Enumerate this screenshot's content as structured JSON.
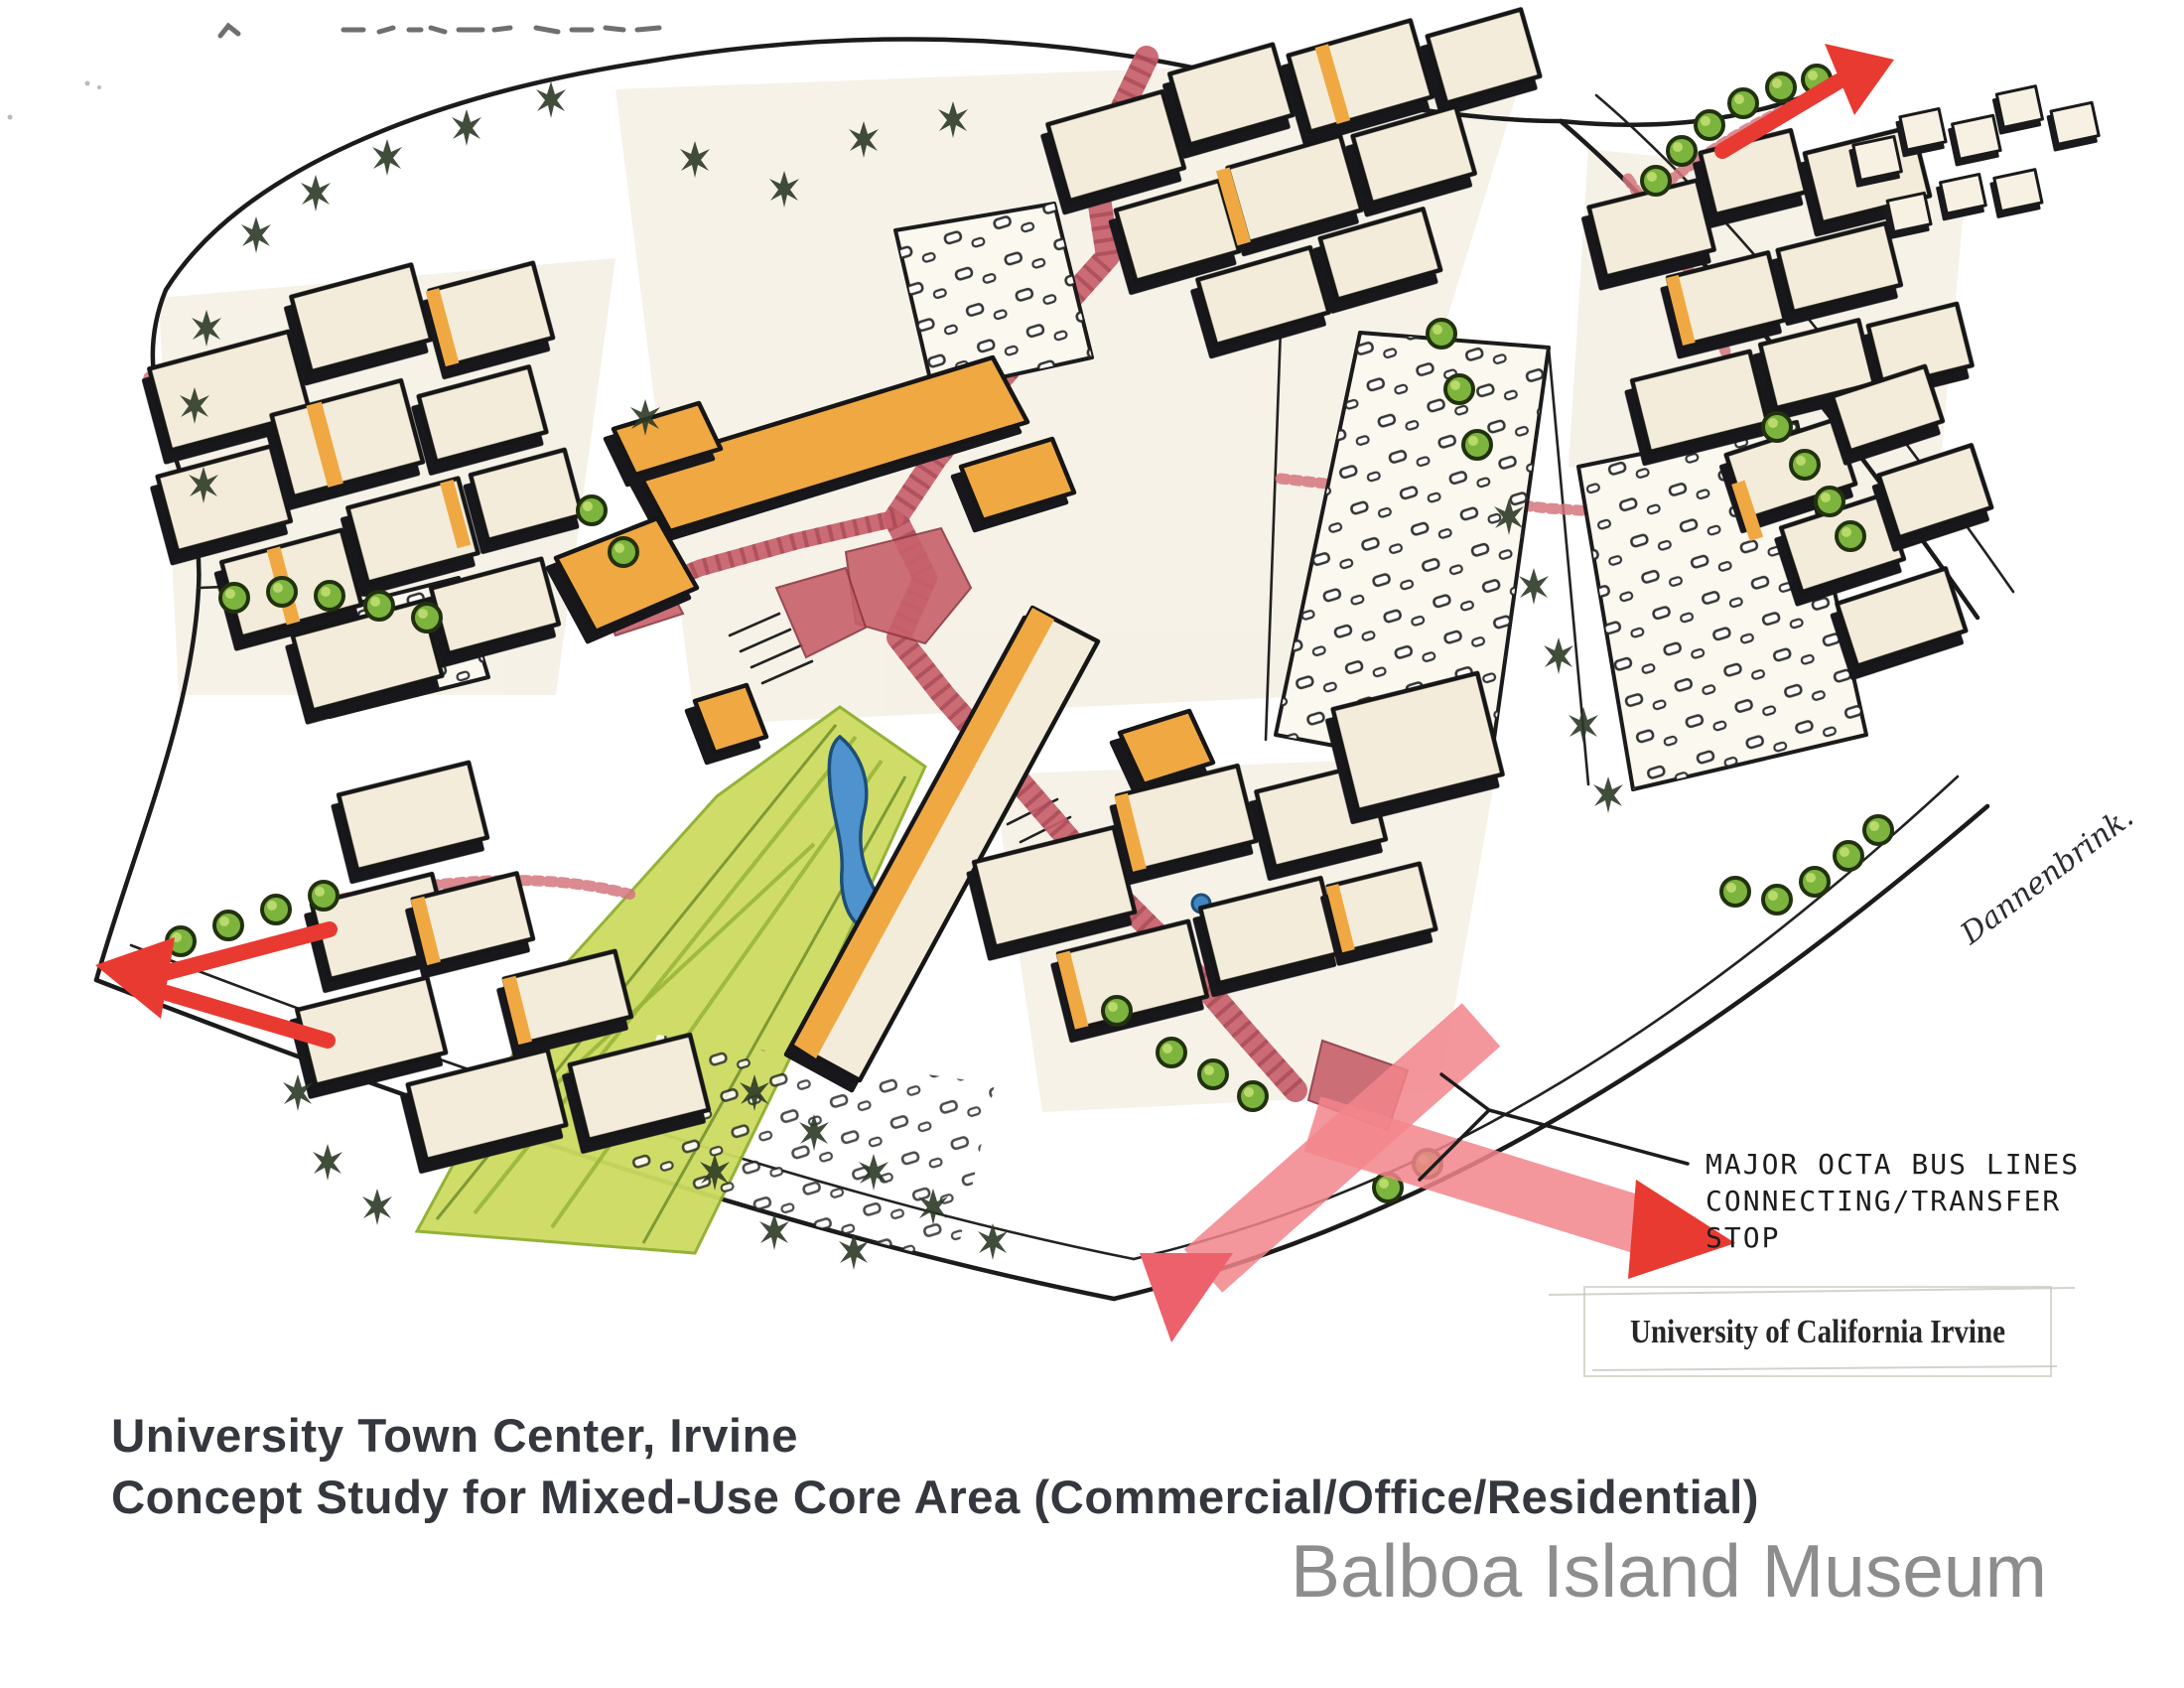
{
  "page": {
    "caption": {
      "line1": "University Town Center, Irvine",
      "line2": "Concept Study for Mixed-Use Core Area (Commercial/Office/Residential)"
    },
    "watermark": "Balboa Island Museum"
  },
  "annotations": {
    "bus_note": {
      "line1": "MAJOR OCTA BUS LINES",
      "line2": "CONNECTING/TRANSFER",
      "line3": "STOP"
    },
    "uci_label": "University of California Irvine",
    "signature": "Dannenbrink."
  },
  "legend_colors": {
    "ink_black": "#1b1b1b",
    "building_tan": "#f3ecda",
    "accent_orange": "#f0a843",
    "pedestrian_red": "#c7606a",
    "bus_band_pink": "#f2858c",
    "arrow_red": "#e93a31",
    "tree_green": "#7cb43e",
    "park_green": "#cddc60",
    "pond_blue": "#4e93cd"
  }
}
